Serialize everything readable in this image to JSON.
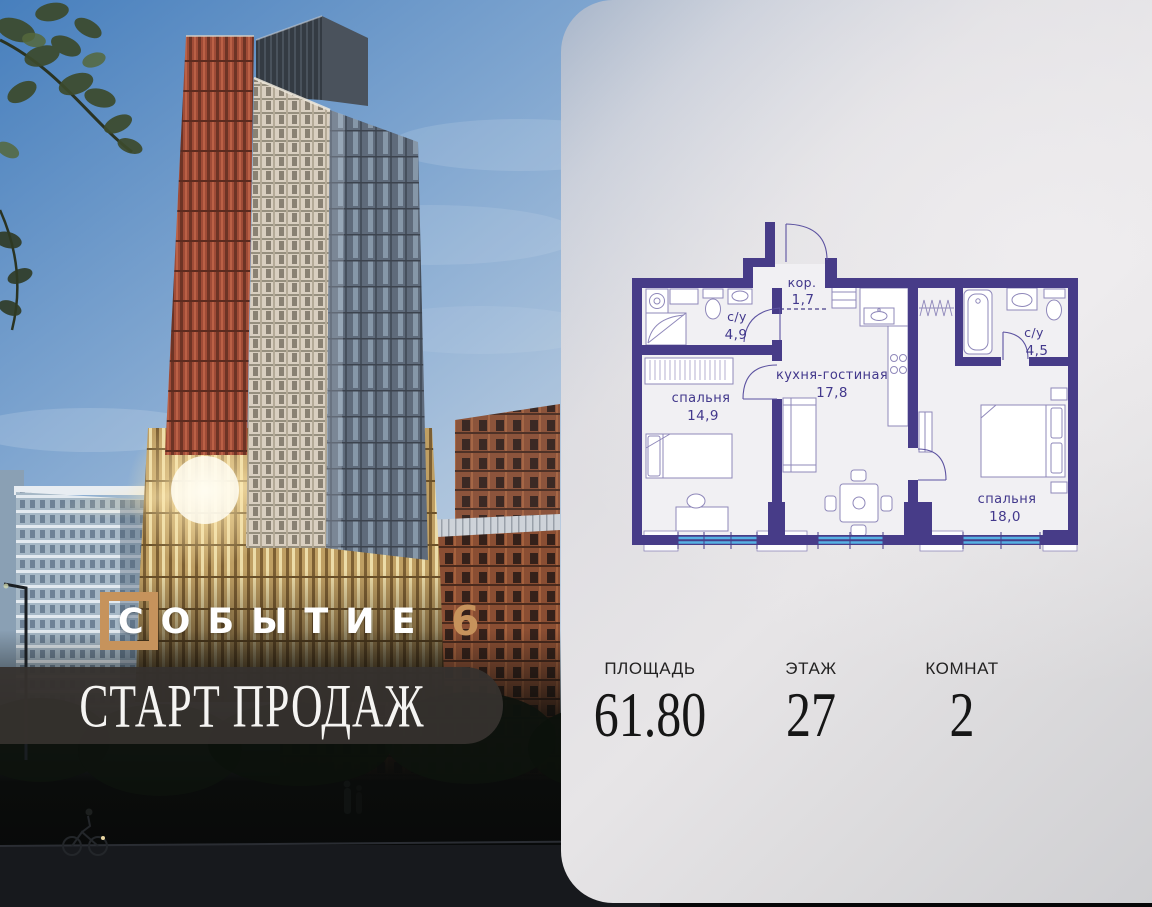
{
  "brand": {
    "name": "СОБЫТИЕ",
    "number": "6",
    "framed_letter": "С"
  },
  "banner": {
    "text": "СТАРТ ПРОДАЖ"
  },
  "plan": {
    "rooms": [
      {
        "name": "кор.",
        "area": "1,7"
      },
      {
        "name": "с/у",
        "area": "4,9"
      },
      {
        "name": "кухня-гостиная",
        "area": "17,8"
      },
      {
        "name": "с/у",
        "area": "4,5"
      },
      {
        "name": "спальня",
        "area": "14,9"
      },
      {
        "name": "спальня",
        "area": "18,0"
      }
    ]
  },
  "stats": {
    "area": {
      "label": "ПЛОЩАДЬ",
      "value": "61.80"
    },
    "floor": {
      "label": "ЭТАЖ",
      "value": "27"
    },
    "rooms": {
      "label": "КОМНАТ",
      "value": "2"
    }
  },
  "colors": {
    "plan_wall": "#473c88",
    "plan_window_blue": "#56b1e3",
    "brand_accent": "#c6935c",
    "banner_bg": "#36312e"
  }
}
